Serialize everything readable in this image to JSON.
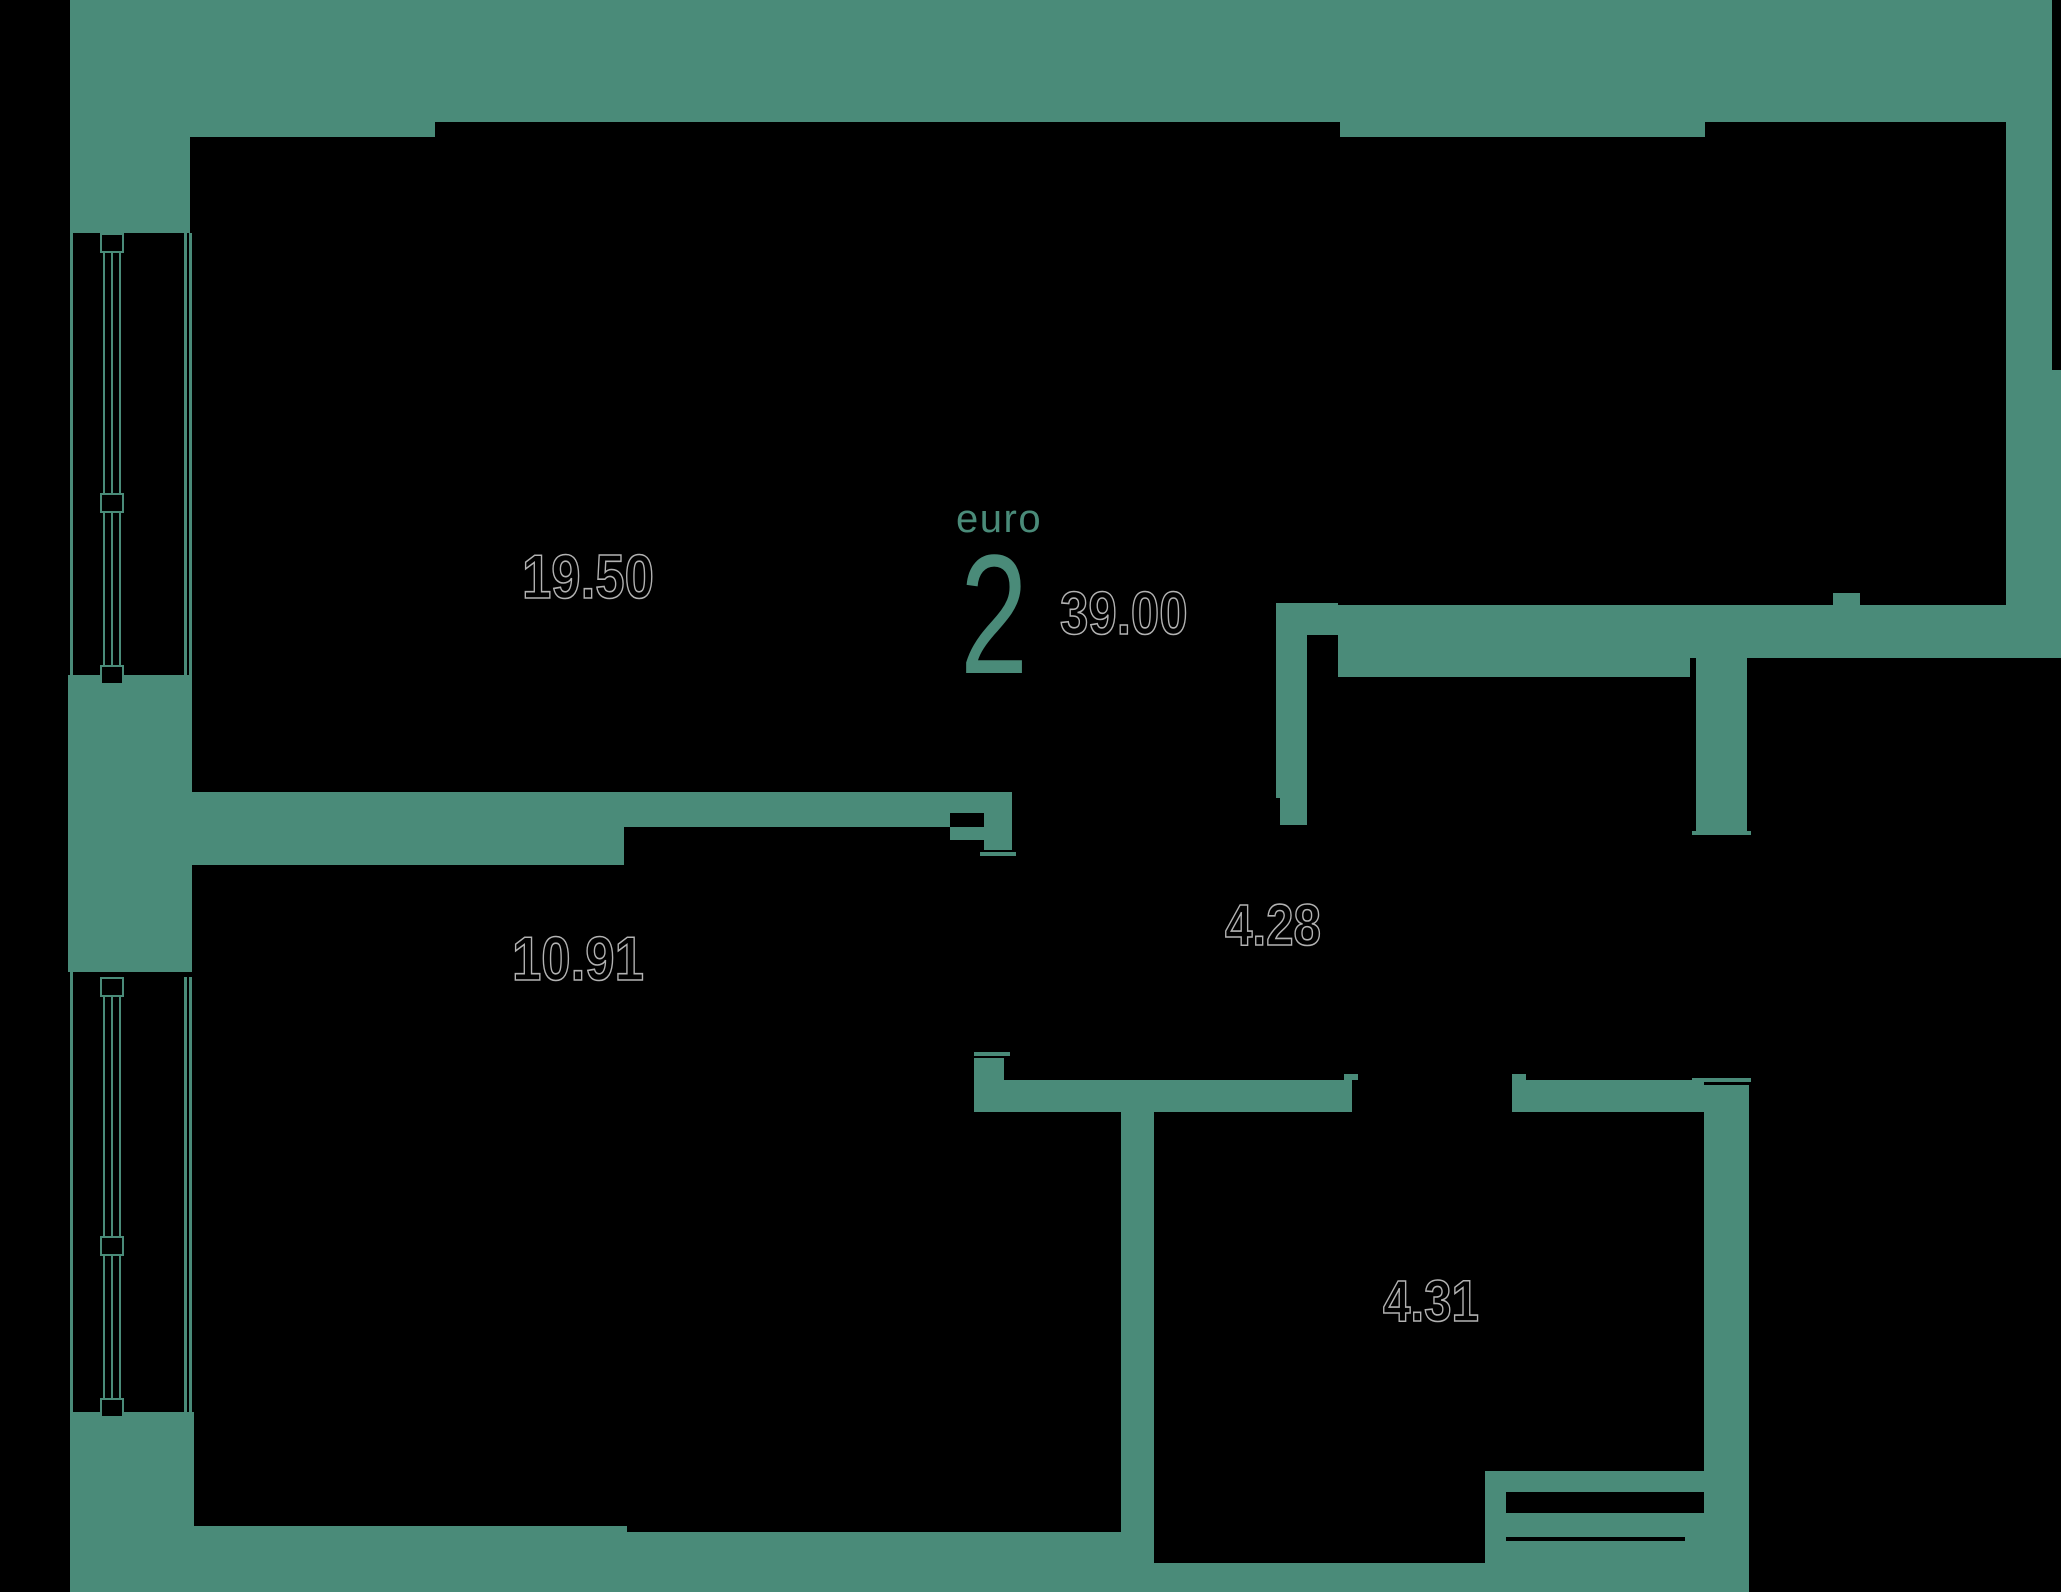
{
  "colors": {
    "bg": "#000000",
    "wall": "#4a8b79",
    "outline": "#b2b2b2",
    "accent": "#4a8b79"
  },
  "unit_badge": {
    "type_label": "euro",
    "rooms_count": "2",
    "total_area": "39.00"
  },
  "rooms": [
    {
      "id": "living-room",
      "area": "19.50"
    },
    {
      "id": "bedroom",
      "area": "10.91"
    },
    {
      "id": "hallway",
      "area": "4.28"
    },
    {
      "id": "bathroom",
      "area": "4.31"
    }
  ]
}
